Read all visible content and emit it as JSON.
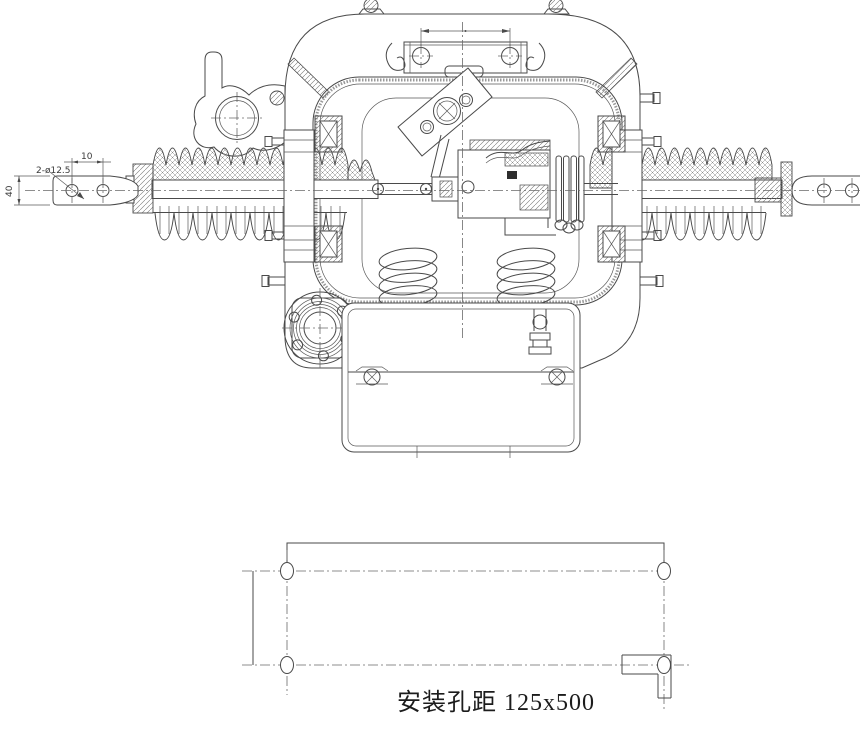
{
  "meta": {
    "background_color": "#ffffff",
    "line_color": "#4a4a4a",
    "drawing_type": "engineering-cross-section"
  },
  "main_view": {
    "dimensions": {
      "terminal_holes_label": "2-ø12.5",
      "terminal_hole_spacing": "10",
      "terminal_width": "40"
    }
  },
  "plan_view": {
    "caption": "安装孔距 125x500"
  }
}
